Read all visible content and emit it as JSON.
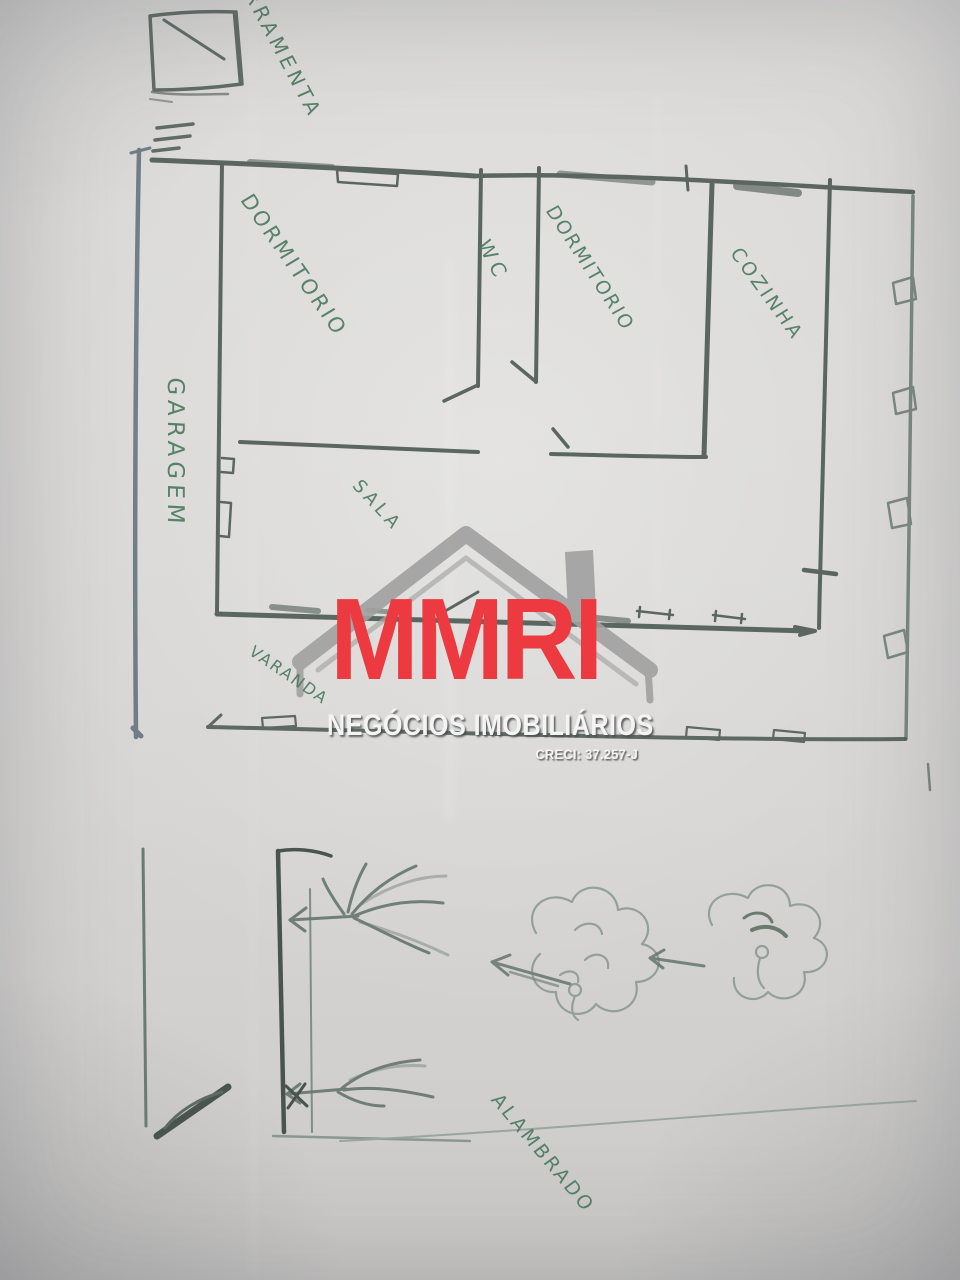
{
  "plan": {
    "labels": {
      "ferramenta": "FERRAMENTA",
      "dormitorio_1": "DORMITORIO",
      "wc": "WC",
      "dormitorio_2": "DORMITORIO",
      "cozinha": "COZINHA",
      "garagem": "GARAGEM",
      "sala": "SALA",
      "varanda": "VARANDA",
      "alambrado": "ALAMBRADO"
    },
    "ink_color": "#4d5953",
    "boundary_color": "#5e6e79",
    "pencil_color": "#8a9793",
    "label_color": "#4c7a60"
  },
  "watermark": {
    "brand": "MMRI",
    "subtitle": "NEGÓCIOS IMOBILIÁRIOS",
    "license": "CRECI: 37.257-J",
    "brand_color": "#ec3a40",
    "text_color": "#f4f4f4",
    "roof_color": "#a0a0a0"
  }
}
